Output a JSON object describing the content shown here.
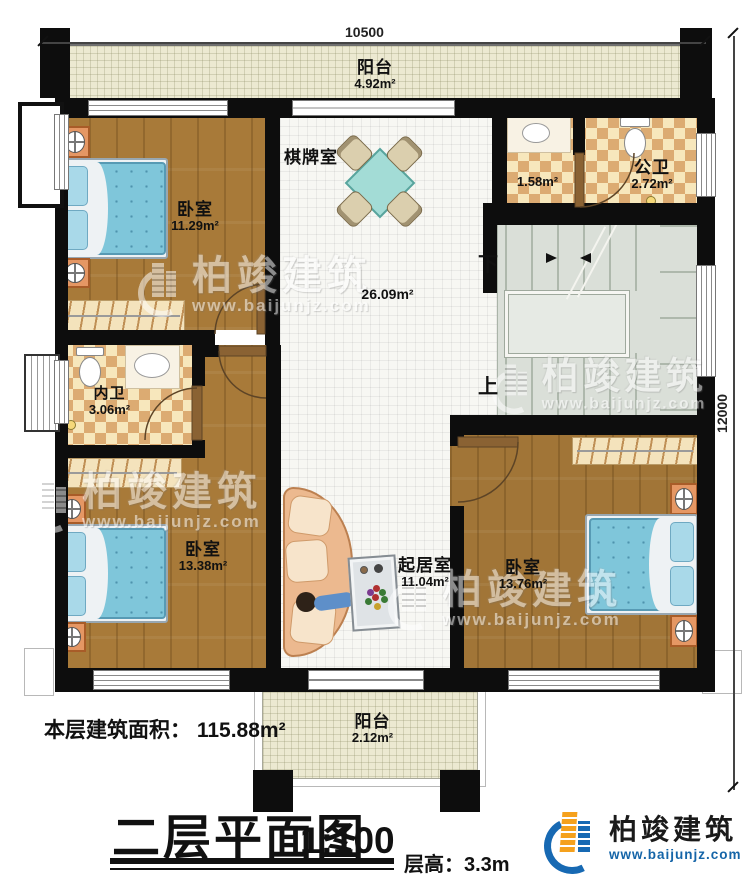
{
  "dimensions": {
    "top": "10500",
    "right": "12000"
  },
  "stairs": {
    "down_label": "下",
    "up_label": "上"
  },
  "rooms": {
    "balcony_top": {
      "name": "阳台",
      "area": "4.92m²"
    },
    "bedroom_top_left": {
      "name": "卧室",
      "area": "11.29m²"
    },
    "chess_room": {
      "name": "棋牌室"
    },
    "hall": {
      "area": "26.09m²"
    },
    "wash_area": {
      "area": "1.58m²"
    },
    "public_bathroom": {
      "name": "公卫",
      "area": "2.72m²"
    },
    "private_bathroom": {
      "name": "内卫",
      "area": "3.06m²"
    },
    "bedroom_bottom_left": {
      "name": "卧室",
      "area": "13.38m²"
    },
    "living_room": {
      "name": "起居室",
      "area": "11.04m²"
    },
    "bedroom_bottom_right": {
      "name": "卧室",
      "area": "13.76m²"
    },
    "balcony_bottom": {
      "name": "阳台",
      "area": "2.12m²"
    }
  },
  "footer": {
    "floor_area_label": "本层建筑面积：",
    "floor_area_value": "115.88m²",
    "title": "二层平面图",
    "scale": "1:100",
    "floor_height": "层高：3.3m"
  },
  "branding": {
    "watermark_name": "柏竣建筑",
    "watermark_url": "www.baijunjz.com",
    "logo_name": "柏竣建筑",
    "logo_url": "www.baijunjz.com"
  },
  "colors": {
    "wall": "#0d0d0d",
    "wood_floor": "#a87a39",
    "balcony_floor": "#ece9d1",
    "bath_checker_dark": "#dcab72",
    "bath_checker_light": "#f7e7bc",
    "stairs": "#dadfd8",
    "bed_blue": "#7fc6da",
    "nightstand_orange": "#e59764",
    "logo_blue": "#1769b3",
    "logo_orange": "#f5a11d"
  }
}
